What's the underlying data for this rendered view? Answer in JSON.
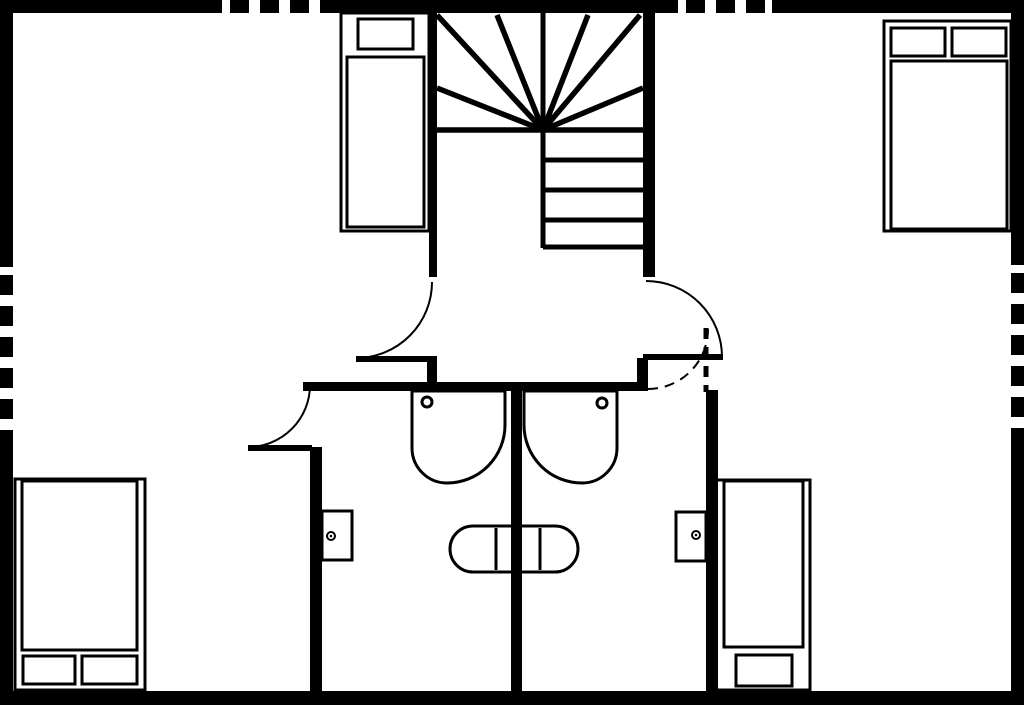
{
  "floor_plan": {
    "background": "#ffffff",
    "ink": "#000000",
    "canvas": {
      "width": 1024,
      "height": 705
    },
    "fixtures": {
      "tub": {
        "rect": [
          450,
          526,
          128,
          46
        ],
        "rx": 23,
        "dividers": [
          [
            496,
            528,
            496,
            570
          ],
          [
            540,
            528,
            540,
            570
          ]
        ]
      },
      "sinks": [
        {
          "name": "basin-left",
          "path": "M 412 391 V 448 A 35 35 0 0 0 447 483 A 58 58 0 0 0 505 425 V 391 Z",
          "drain": {
            "cx": 427,
            "cy": 402,
            "r": 5
          }
        },
        {
          "name": "basin-right",
          "path": "M 617 391 V 448 A 35 35 0 0 1 582 483 A 58 58 0 0 1 524 425 V 391 Z",
          "drain": {
            "cx": 602,
            "cy": 403,
            "r": 5
          }
        }
      ],
      "wall_boxes": [
        {
          "name": "wall-box-left",
          "rect": [
            322,
            511,
            30,
            49
          ],
          "knob": {
            "cx": 331,
            "cy": 536
          }
        },
        {
          "name": "wall-box-right",
          "rect": [
            676,
            512,
            30,
            49
          ],
          "knob": {
            "cx": 696,
            "cy": 535
          }
        }
      ]
    },
    "beds": [
      {
        "name": "bed-top-left",
        "frame": [
          341,
          13,
          88,
          218
        ],
        "mattress": [
          347,
          57,
          77,
          170
        ],
        "pillows": [
          [
            358,
            19,
            55,
            30
          ]
        ]
      },
      {
        "name": "bed-top-right",
        "frame": [
          884,
          21,
          127,
          210
        ],
        "mattress": [
          891,
          61,
          116,
          168
        ],
        "pillows": [
          [
            891,
            28,
            54,
            28
          ],
          [
            952,
            28,
            54,
            28
          ]
        ]
      },
      {
        "name": "bed-bottom-left",
        "frame": [
          15,
          479,
          130,
          211
        ],
        "mattress": [
          22,
          481,
          115,
          169
        ],
        "pillows": [
          [
            23,
            656,
            52,
            28
          ],
          [
            82,
            656,
            55,
            28
          ]
        ]
      },
      {
        "name": "bed-bottom-right",
        "frame": [
          716,
          480,
          94,
          210
        ],
        "mattress": [
          724,
          481,
          79,
          166
        ],
        "pillows": [
          [
            736,
            655,
            56,
            31
          ]
        ]
      }
    ],
    "stairs": {
      "lines": [
        [
          543,
          10,
          543,
          131,
          5
        ],
        [
          543,
          130,
          437,
          130,
          5.5
        ],
        [
          543,
          130,
          437,
          88,
          5.5
        ],
        [
          543,
          130,
          437,
          15,
          5.5
        ],
        [
          543,
          130,
          497,
          15,
          5.5
        ],
        [
          543,
          130,
          588,
          15,
          5.5
        ],
        [
          543,
          130,
          640,
          15,
          5.5
        ],
        [
          543,
          130,
          643,
          88,
          5.5
        ],
        [
          543,
          130,
          643,
          130,
          5.5
        ],
        [
          543,
          130,
          543,
          248,
          5
        ],
        [
          543,
          160,
          643,
          160,
          5
        ],
        [
          543,
          190,
          643,
          190,
          5
        ],
        [
          543,
          220,
          643,
          220,
          5
        ],
        [
          543,
          247,
          643,
          247,
          5
        ]
      ]
    },
    "walls": [
      {
        "name": "top-wall-left",
        "rect": [
          0,
          0,
          222,
          13
        ]
      },
      {
        "name": "top-wall-middle",
        "rect": [
          320,
          0,
          358,
          13
        ]
      },
      {
        "name": "top-wall-right",
        "rect": [
          772,
          0,
          252,
          13
        ]
      },
      {
        "name": "left-wall-upper",
        "rect": [
          0,
          0,
          13,
          267
        ]
      },
      {
        "name": "left-wall-lower",
        "rect": [
          0,
          437,
          13,
          268
        ]
      },
      {
        "name": "right-wall-upper",
        "rect": [
          1011,
          0,
          13,
          265
        ]
      },
      {
        "name": "right-wall-lower",
        "rect": [
          1011,
          435,
          13,
          270
        ]
      },
      {
        "name": "bottom-wall",
        "rect": [
          0,
          691,
          1024,
          14
        ]
      },
      {
        "name": "stairwell-wall-left",
        "rect": [
          429,
          13,
          8,
          264
        ]
      },
      {
        "name": "stairwell-wall-right",
        "rect": [
          643,
          13,
          12,
          264
        ]
      },
      {
        "name": "hall-wall",
        "rect": [
          303,
          382,
          345,
          9
        ]
      },
      {
        "name": "door-post-left",
        "rect": [
          427,
          358,
          10,
          24
        ]
      },
      {
        "name": "door-post-right",
        "rect": [
          637,
          358,
          11,
          24
        ]
      },
      {
        "name": "bathroom-wall-west",
        "rect": [
          310,
          447,
          12,
          244
        ]
      },
      {
        "name": "bathroom-wall-center",
        "rect": [
          511,
          391,
          11,
          300
        ]
      },
      {
        "name": "bathroom-wall-east",
        "rect": [
          706,
          390,
          12,
          301
        ]
      }
    ],
    "windows": [
      {
        "name": "window-top-left",
        "line": [
          230,
          6.5,
          320,
          6.5
        ],
        "dash": "19 11"
      },
      {
        "name": "window-top-right",
        "line": [
          686,
          6.5,
          772,
          6.5
        ],
        "dash": "19 11"
      },
      {
        "name": "window-left",
        "line": [
          6.5,
          275,
          6.5,
          437
        ],
        "dash": "20 11"
      },
      {
        "name": "window-right",
        "line": [
          1017.5,
          273,
          1017.5,
          435
        ],
        "dash": "20 11"
      }
    ],
    "doors": [
      {
        "name": "door-landing-left",
        "leaf_rect": [
          356,
          356,
          81,
          6
        ],
        "arc": "M 356 358 A 76 76 0 0 0 432 282",
        "dashed": false
      },
      {
        "name": "door-landing-right",
        "leaf_rect": [
          643,
          354,
          80,
          6
        ],
        "arc": "M 646 281 A 76 76 0 0 1 722 357",
        "dashed": false
      },
      {
        "name": "door-bedroom-left",
        "leaf_rect": [
          248,
          445,
          64,
          6
        ],
        "arc": "M 248 447 A 62 62 0 0 0 310 385",
        "dashed": false
      },
      {
        "name": "door-bathroom-right",
        "leaf_line": [
          706,
          328,
          706,
          392
        ],
        "arc": "M 648 389 A 60 60 0 0 0 708 329",
        "dashed": true
      }
    ]
  }
}
